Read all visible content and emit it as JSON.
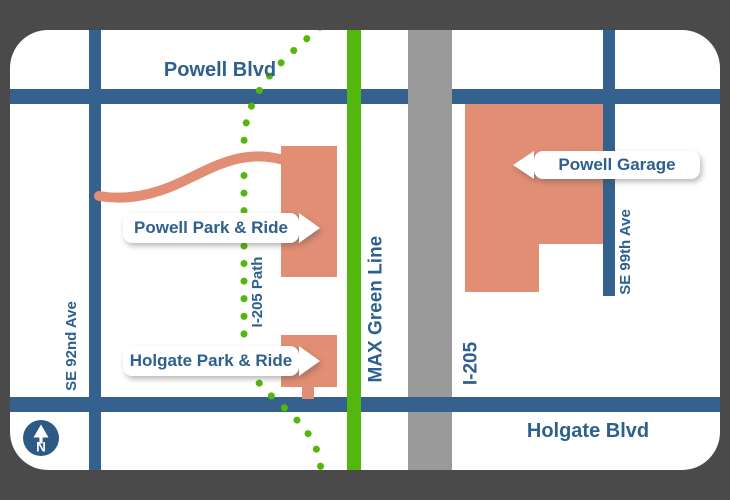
{
  "map": {
    "streets": {
      "powell_blvd": "Powell Blvd",
      "holgate_blvd": "Holgate Blvd",
      "se_92nd_ave": "SE 92nd Ave",
      "se_99th_ave": "SE 99th Ave"
    },
    "transit": {
      "max_line": "MAX Green Line",
      "freeway": "I-205",
      "path": "I-205 Path"
    },
    "callouts": {
      "powell_park_ride": "Powell Park & Ride",
      "holgate_park_ride": "Holgate Park & Ride",
      "powell_garage": "Powell Garage"
    },
    "compass": {
      "north_label": "N"
    }
  },
  "colors": {
    "frame": "#4A4A4A",
    "road_blue": "#35618E",
    "text_blue": "#2E608F",
    "max_green": "#53B70D",
    "facility_salmon": "#E18E74",
    "freeway_gray": "#9A9A9A",
    "compass_blue": "#2C5985"
  }
}
